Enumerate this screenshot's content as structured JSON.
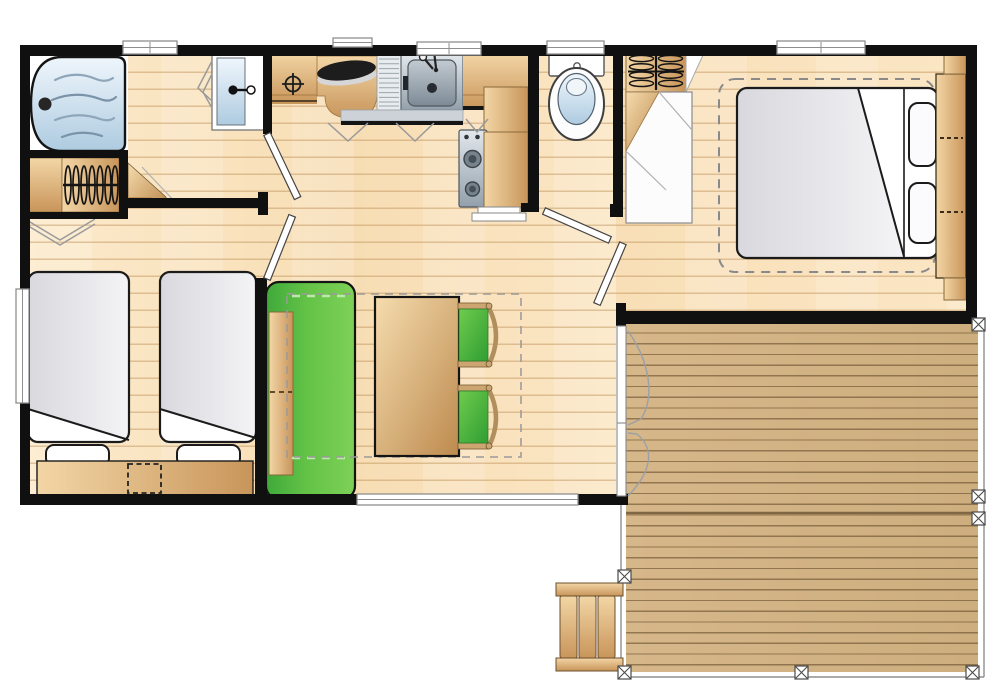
{
  "illustration": {
    "kind": "mobile-home floor plan, top-down view",
    "visible_text": "none"
  },
  "palette": {
    "background": "#ffffff",
    "wall": "#101010",
    "floor_light": "#fceacb",
    "floor_mid": "#f7ddb4",
    "floor_seam": "#bb8d54",
    "deck_light": "#d6b78a",
    "deck_mid": "#cdae7e",
    "deck_seam": "#5b4222",
    "wood_light": "#f3d6a6",
    "wood_dark": "#c8955a",
    "green_light": "#7ed157",
    "green_dark": "#3fa93a",
    "water_light": "#eff6fc",
    "water_dark": "#aecbe0",
    "steel_light": "#e2e7eb",
    "steel_dark": "#93a0ab",
    "duvet_light": "#f4f4f6",
    "duvet_dark": "#d8d8de",
    "dashed_guide": "#9a9a9a",
    "window_fill": "#ffffff",
    "outline": "#1b1b1b"
  },
  "rooms": {
    "bathroom": [
      "bathtub",
      "washbasin",
      "mirror-marks",
      "hanging-wardrobe",
      "corner-shelf",
      "bifold-marks",
      "window"
    ],
    "kitchen": [
      "worktop",
      "utility-connection-symbol",
      "worktop-cover",
      "drainboard",
      "kitchen-sink",
      "faucet",
      "wall-cabinet",
      "cooktop",
      "refrigerator",
      "plinth",
      "cabinet-door-marks",
      "window"
    ],
    "wc": [
      "toilet",
      "window",
      "door"
    ],
    "master_bedroom": [
      "double-bed",
      "duvet",
      "pillows",
      "headboard",
      "clearance-outline",
      "hanging-wardrobe",
      "dressing-shelf",
      "window",
      "door"
    ],
    "twin_bedroom": [
      "single-bed",
      "single-bed",
      "pillows",
      "headboard",
      "bedside-dashed-box",
      "window",
      "door"
    ],
    "living_dining": [
      "bench-sofa",
      "dining-table",
      "chair",
      "chair",
      "dining-clearance-outline",
      "picture-window",
      "french-door"
    ],
    "terrace": [
      "deck-boards",
      "railing",
      "posts",
      "stairs"
    ]
  }
}
